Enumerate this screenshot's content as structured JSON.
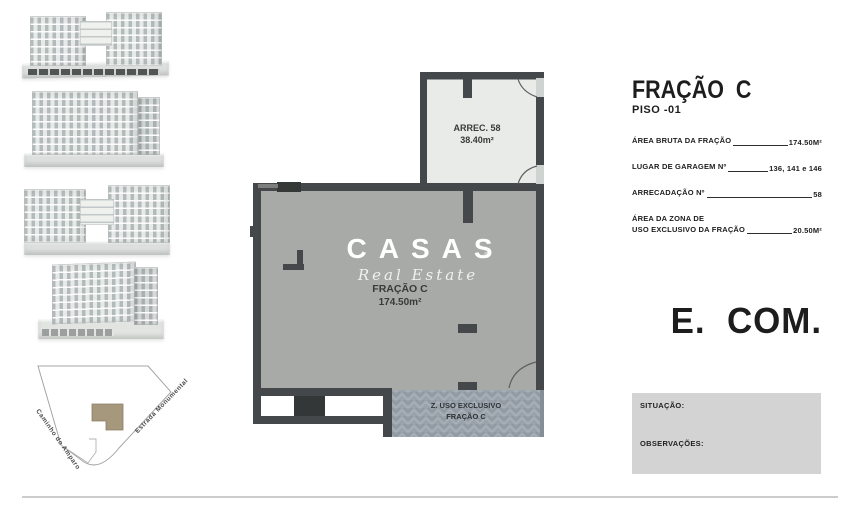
{
  "sidebar": {
    "site_plan": {
      "road_left": "Caminho do Amparo",
      "road_right": "Estrada Monumental"
    }
  },
  "plan": {
    "storage": {
      "name": "ARREC. 58",
      "area": "38.40m²"
    },
    "watermark": {
      "brand": "CASAS",
      "registered": "®",
      "subtitle": "Real Estate"
    },
    "fraction": {
      "name": "FRAÇÃO C",
      "area": "174.50m²"
    },
    "exclusive_zone": {
      "line1": "Z. USO EXCLUSIVO",
      "line2": "FRAÇÃO C"
    }
  },
  "info_panel": {
    "title": "FRAÇÃO  C",
    "subtitle": "PISO -01",
    "rows": [
      {
        "label": "ÁREA BRUTA DA FRAÇÃO",
        "value": "174.50M²"
      },
      {
        "label": "LUGAR DE GARAGEM Nº",
        "value": "136, 141 e 146"
      },
      {
        "label": "ARRECADAÇÃO Nº",
        "value": "58"
      },
      {
        "label_line1": "ÁREA DA ZONA DE",
        "label_line2": "USO EXCLUSIVO DA FRAÇÃO",
        "value": "20.50M²"
      }
    ],
    "big_label": "E.  COM.",
    "notes": {
      "situacao_label": "SITUAÇÃO:",
      "observacoes_label": "OBSERVAÇÕES:"
    }
  },
  "colors": {
    "wall": "#45484a",
    "room_fill": "#a8aaa7",
    "storage_fill": "#e9ebe8",
    "exclusive_fill": "#9aa3ab",
    "footprint_tan": "#a5987c",
    "notes_box": "#d2d3d2"
  }
}
